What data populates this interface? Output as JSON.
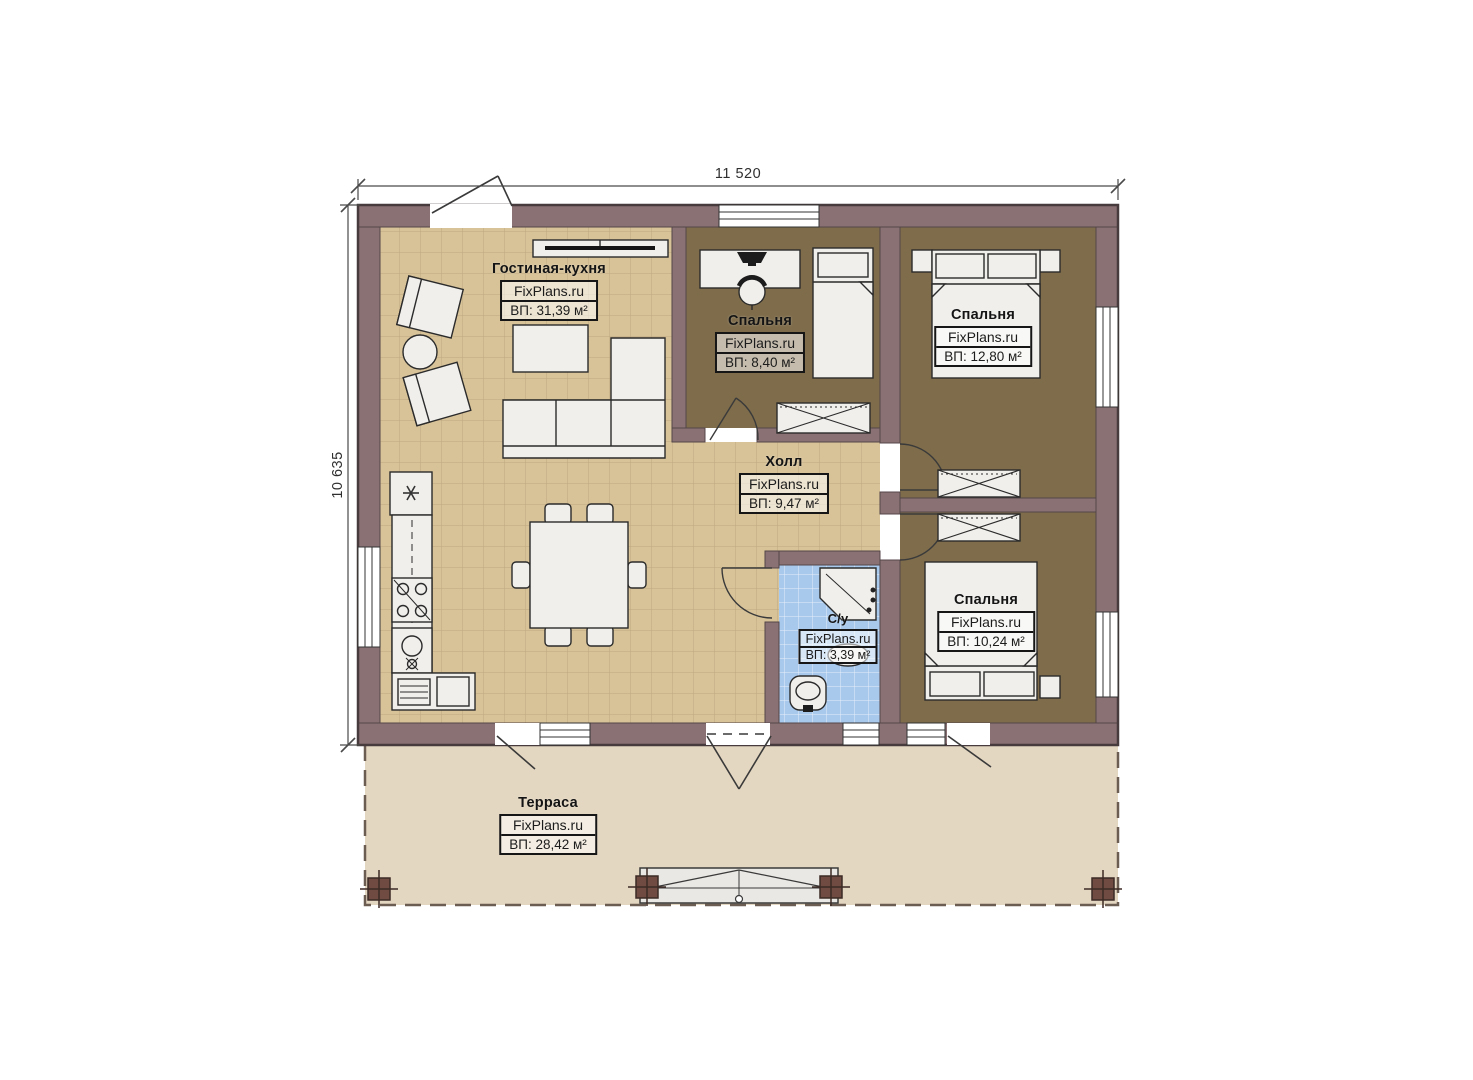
{
  "plan_title": "floor-plan",
  "dimensions": {
    "top": "11 520",
    "left": "10 635"
  },
  "rooms": {
    "living": {
      "name": "Гостиная-кухня",
      "brand": "FixPlans.ru",
      "area": "ВП: 31,39 м²"
    },
    "bedroom_top": {
      "name": "Спальня",
      "brand": "FixPlans.ru",
      "area": "ВП: 8,40 м²"
    },
    "bedroom_right": {
      "name": "Спальня",
      "brand": "FixPlans.ru",
      "area": "ВП: 12,80 м²"
    },
    "hall": {
      "name": "Холл",
      "brand": "FixPlans.ru",
      "area": "ВП: 9,47 м²"
    },
    "bathroom": {
      "name": "С/у",
      "brand": "FixPlans.ru",
      "area": "ВП: 3,39 м²"
    },
    "bedroom_bottom": {
      "name": "Спальня",
      "brand": "FixPlans.ru",
      "area": "ВП: 10,24 м²"
    },
    "terrace": {
      "name": "Терраса",
      "brand": "FixPlans.ru",
      "area": "ВП: 28,42 м²"
    }
  },
  "colors": {
    "wall": "#8a7174",
    "wall_outline": "#473b3d",
    "floor_tan": "#d8c399",
    "floor_tan_grid": "#a8906a",
    "floor_bedroom": "#7e6c4b",
    "floor_bath": "#a9c9ec",
    "terrace": "#e4d7c1",
    "furniture": "#f0efec",
    "furniture_stroke": "#2b2b2b",
    "post": "#6f4b42"
  }
}
